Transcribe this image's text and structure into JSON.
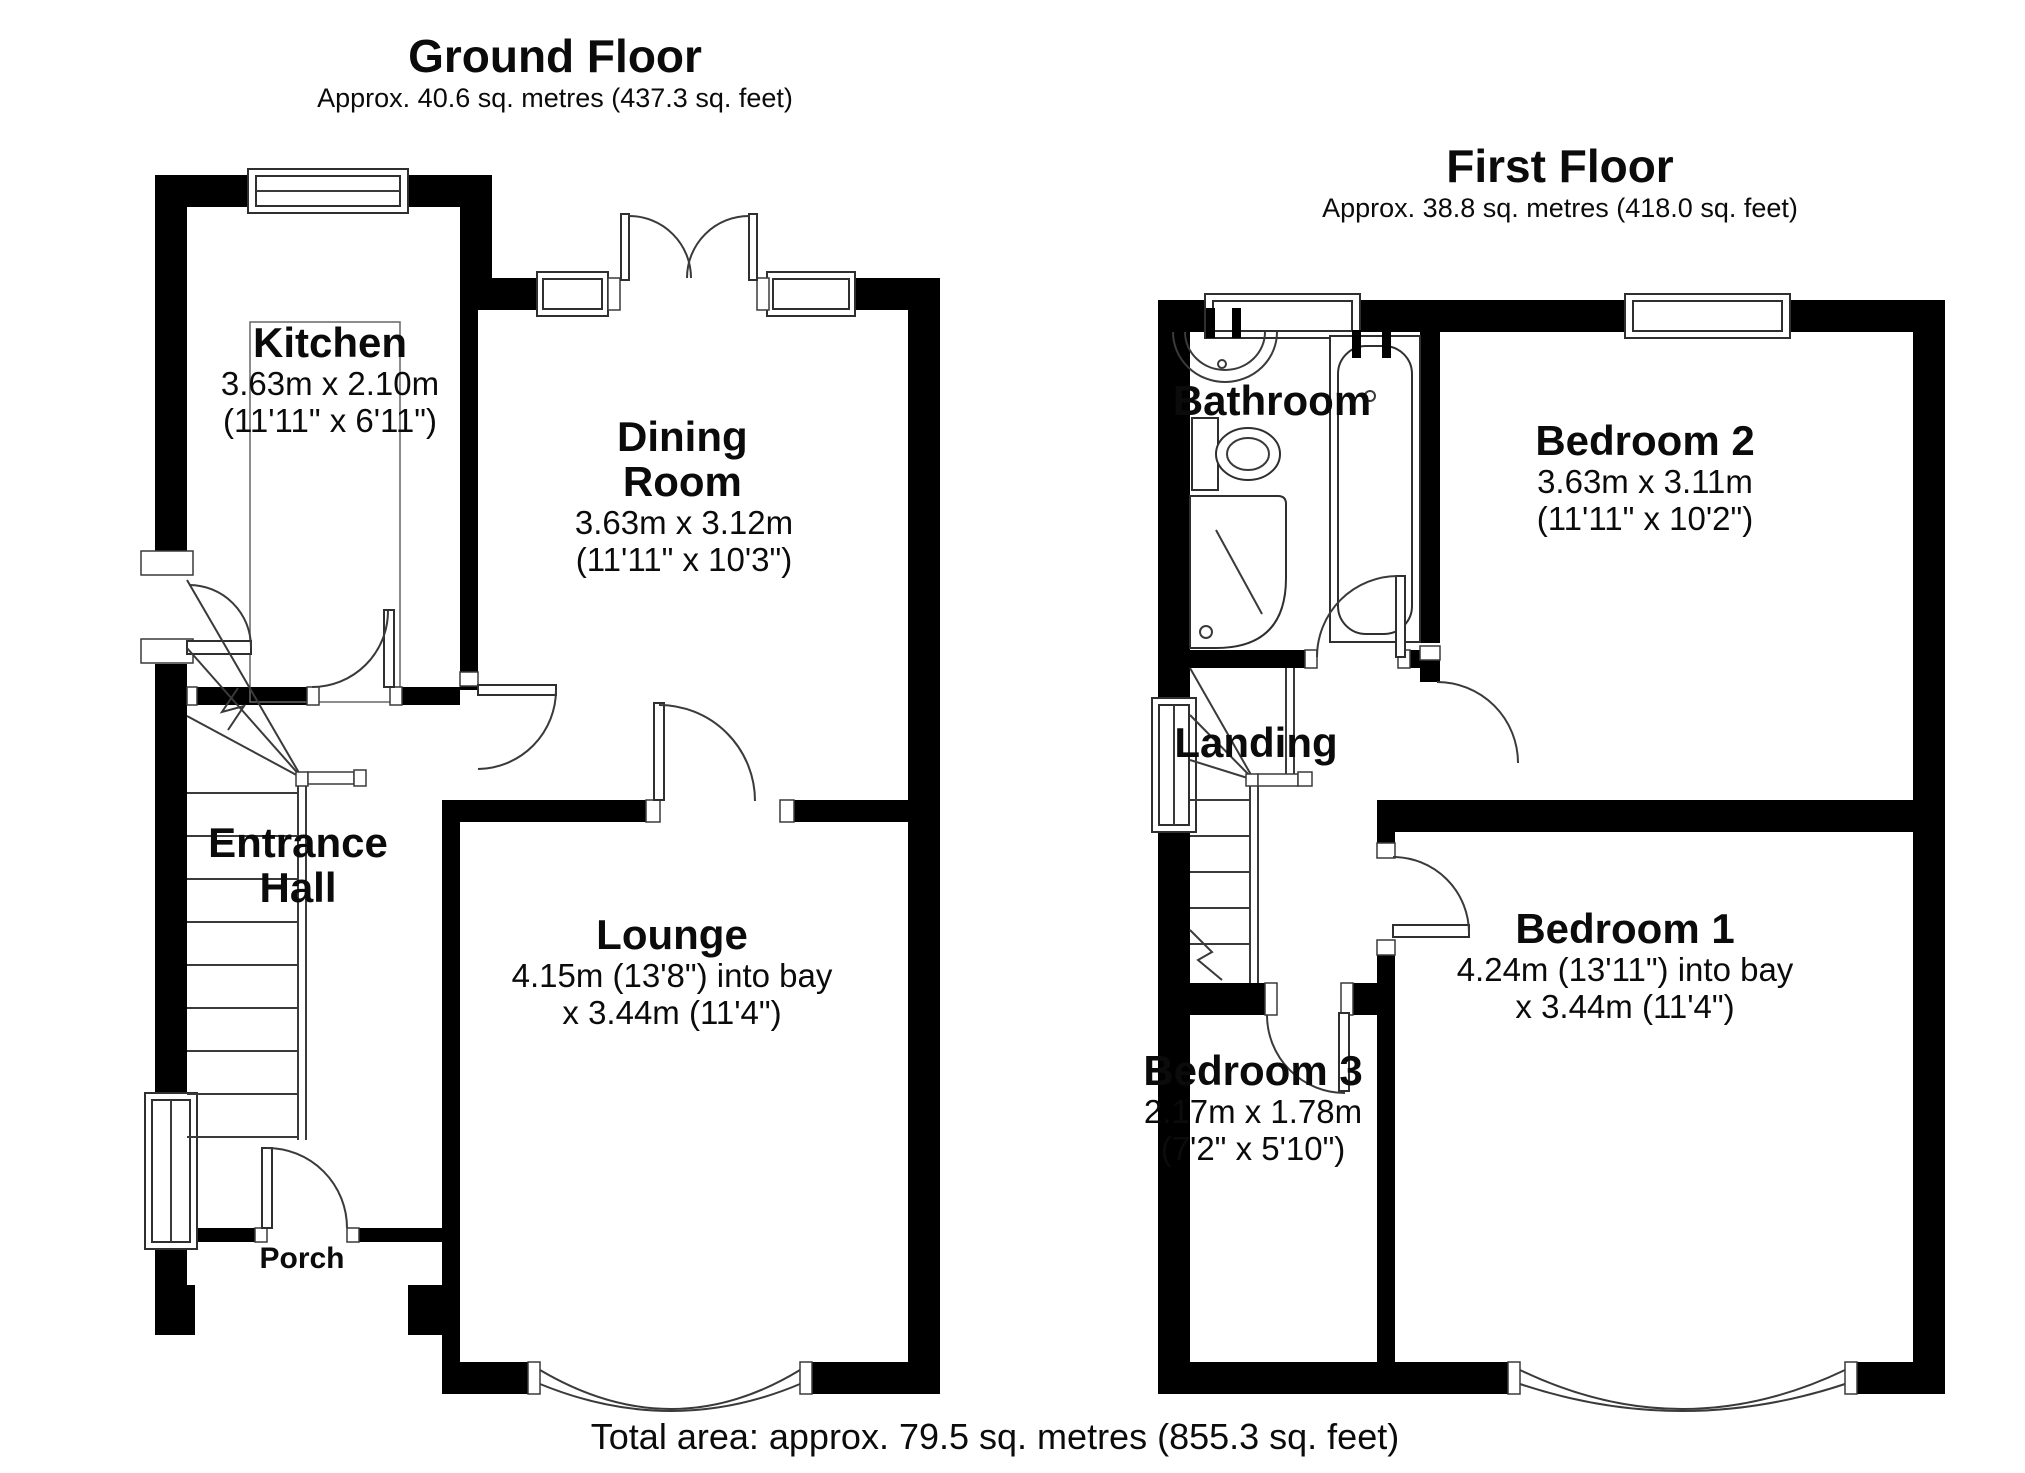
{
  "ground_floor": {
    "title": "Ground Floor",
    "subtitle": "Approx. 40.6 sq. metres (437.3 sq. feet)",
    "rooms": [
      {
        "name": "Kitchen",
        "dims1": "3.63m x 2.10m",
        "dims2": "(11'11\" x 6'11\")"
      },
      {
        "name": "Dining Room",
        "dims1": "3.63m x 3.12m",
        "dims2": "(11'11\" x 10'3\")"
      },
      {
        "name": "Entrance Hall",
        "dims1": "",
        "dims2": ""
      },
      {
        "name": "Lounge",
        "dims1": "4.15m (13'8\") into bay",
        "dims2": "x 3.44m (11'4\")"
      },
      {
        "name": "Porch",
        "dims1": "",
        "dims2": ""
      }
    ]
  },
  "first_floor": {
    "title": "First Floor",
    "subtitle": "Approx. 38.8 sq. metres (418.0 sq. feet)",
    "rooms": [
      {
        "name": "Bathroom",
        "dims1": "",
        "dims2": ""
      },
      {
        "name": "Bedroom 2",
        "dims1": "3.63m x 3.11m",
        "dims2": "(11'11\" x 10'2\")"
      },
      {
        "name": "Landing",
        "dims1": "",
        "dims2": ""
      },
      {
        "name": "Bedroom 1",
        "dims1": "4.24m (13'11\") into bay",
        "dims2": "x 3.44m (11'4\")"
      },
      {
        "name": "Bedroom 3",
        "dims1": "2.17m x 1.78m",
        "dims2": "(7'2\" x 5'10\")"
      }
    ]
  },
  "footer": {
    "total_area": "Total area: approx. 79.5 sq. metres (855.3 sq. feet)"
  }
}
